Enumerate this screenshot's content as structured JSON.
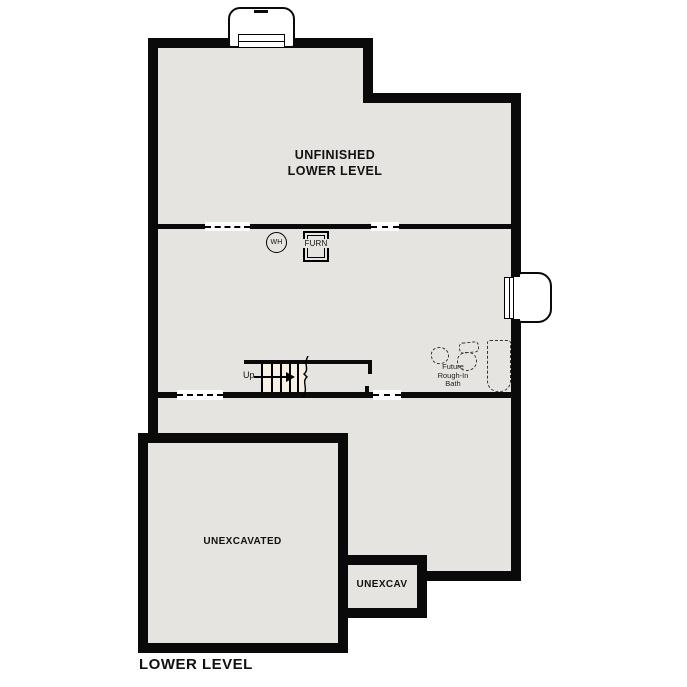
{
  "plan": {
    "title": "LOWER LEVEL"
  },
  "rooms": {
    "unfinished_lower_level": {
      "label_line1": "UNFINISHED",
      "label_line2": "LOWER LEVEL"
    },
    "unexcavated": {
      "label": "UNEXCAVATED"
    },
    "unexcav": {
      "label": "UNEXCAV"
    }
  },
  "fixtures": {
    "water_heater": {
      "label": "WH"
    },
    "furnace": {
      "label": "FURN"
    },
    "stairs": {
      "direction_label": "Up"
    },
    "future_bath": {
      "label_line1": "Future",
      "label_line2": "Rough-In",
      "label_line3": "Bath"
    }
  },
  "colors": {
    "wall": "#0a0a0a",
    "floor": "#e6e4e1",
    "stair": "#f7f1e4",
    "background": "#ffffff",
    "line": "#000000"
  }
}
